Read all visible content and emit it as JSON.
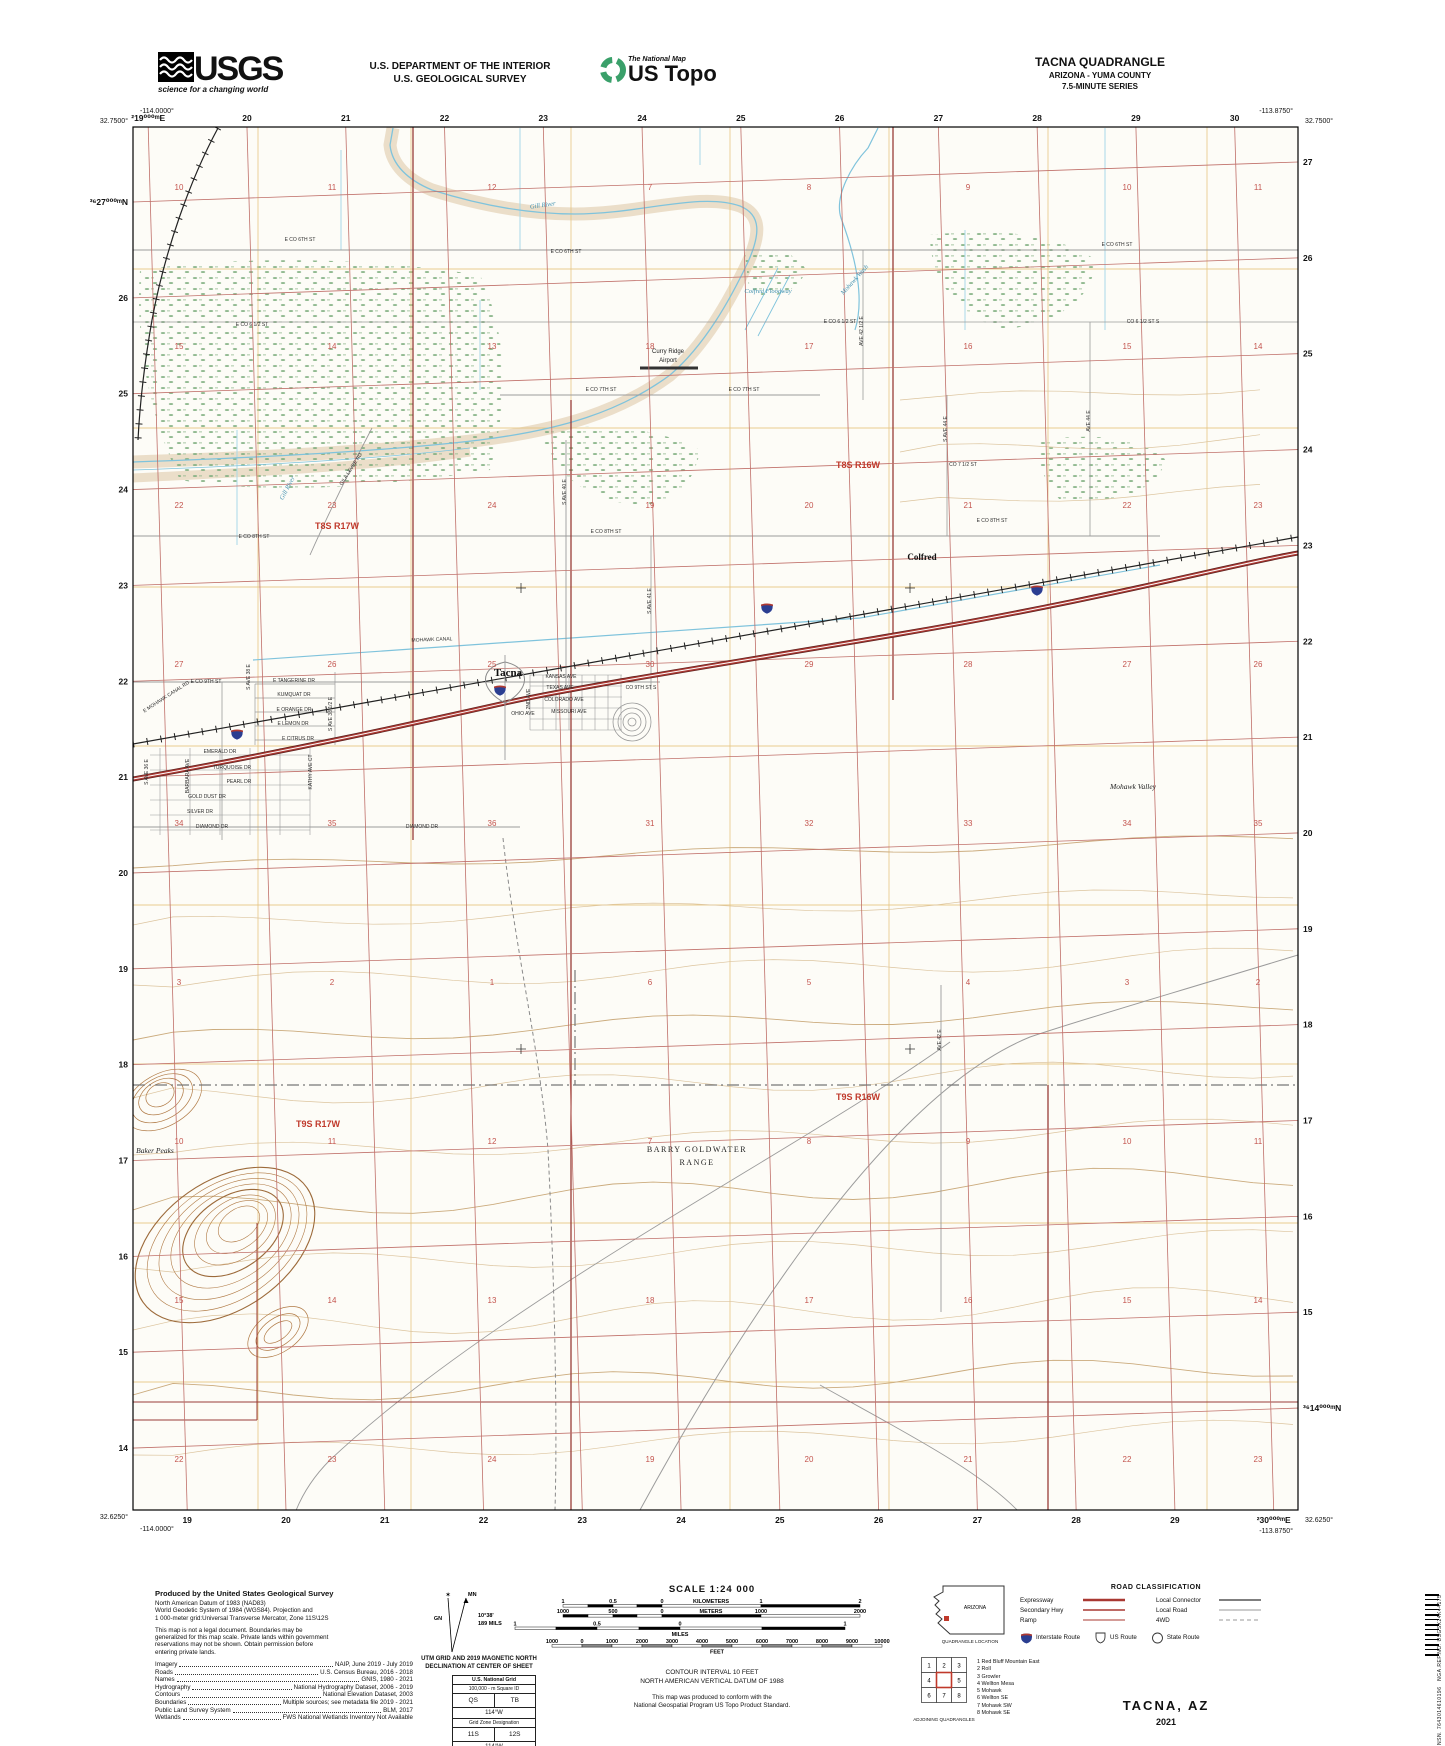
{
  "header": {
    "usgs_logo": {
      "wordmark": "USGS",
      "tagline": "science for a changing world"
    },
    "department_line1": "U.S. DEPARTMENT OF THE INTERIOR",
    "department_line2": "U.S. GEOLOGICAL SURVEY",
    "ustopo_logo": {
      "tagline": "The National Map",
      "title": "US Topo"
    },
    "quadrangle": {
      "title": "TACNA QUADRANGLE",
      "subtitle": "ARIZONA - YUMA COUNTY",
      "series": "7.5-MINUTE SERIES"
    }
  },
  "map": {
    "corner_coords": {
      "top_left_lon": "-114.0000°",
      "top_left_lat": "32.7500°",
      "top_right_lon": "-113.8750°",
      "top_right_lat": "32.7500°",
      "bottom_left_lat": "32.6250°",
      "bottom_left_lon": "-114.0000°",
      "bottom_right_lon": "-113.8750°",
      "bottom_right_lat": "32.6250°"
    },
    "utm_edge_labels": {
      "top": [
        "²19⁰⁰⁰ᵐE",
        "20",
        "21",
        "22",
        "23",
        "24",
        "25",
        "26",
        "27",
        "28",
        "29",
        "30"
      ],
      "bottom": [
        "19",
        "20",
        "21",
        "22",
        "23",
        "24",
        "25",
        "26",
        "27",
        "28",
        "29",
        "²30⁰⁰⁰ᵐE"
      ],
      "left": [
        "³⁶27⁰⁰⁰ᵐN",
        "26",
        "25",
        "24",
        "23",
        "22",
        "21",
        "20",
        "19",
        "18",
        "17",
        "16",
        "15",
        "14"
      ],
      "right": [
        "27",
        "26",
        "25",
        "24",
        "23",
        "22",
        "21",
        "20",
        "19",
        "18",
        "17",
        "16",
        "15",
        "³⁶14⁰⁰⁰ᵐN"
      ]
    },
    "section_numbers": {
      "cols": [
        179,
        332,
        492,
        650,
        809,
        968,
        1127,
        1258
      ],
      "rows": [
        190,
        349,
        508,
        667,
        826,
        985,
        1144,
        1303,
        1462
      ],
      "values": [
        [
          "10",
          "11",
          "12",
          "7",
          "8",
          "9",
          "10",
          "11"
        ],
        [
          "15",
          "14",
          "13",
          "18",
          "17",
          "16",
          "15",
          "14"
        ],
        [
          "22",
          "23",
          "24",
          "19",
          "20",
          "21",
          "22",
          "23"
        ],
        [
          "27",
          "26",
          "25",
          "30",
          "29",
          "28",
          "27",
          "26"
        ],
        [
          "34",
          "35",
          "36",
          "31",
          "32",
          "33",
          "34",
          "35"
        ],
        [
          "3",
          "2",
          "1",
          "6",
          "5",
          "4",
          "3",
          "2"
        ],
        [
          "10",
          "11",
          "12",
          "7",
          "8",
          "9",
          "10",
          "11"
        ],
        [
          "15",
          "14",
          "13",
          "18",
          "17",
          "16",
          "15",
          "14"
        ],
        [
          "22",
          "23",
          "24",
          "19",
          "20",
          "21",
          "22",
          "23"
        ]
      ]
    },
    "township_labels": [
      {
        "t": "T8S R17W",
        "x": 337,
        "y": 529
      },
      {
        "t": "T8S R16W",
        "x": 858,
        "y": 468
      },
      {
        "t": "T9S R17W",
        "x": 318,
        "y": 1127
      },
      {
        "t": "T9S R16W",
        "x": 858,
        "y": 1100
      }
    ],
    "place_labels": [
      {
        "t": "Tacna",
        "x": 508,
        "y": 676,
        "c": "t-place"
      },
      {
        "t": "Colfred",
        "x": 922,
        "y": 560,
        "c": "t-place2"
      },
      {
        "t": "Curry Ridge",
        "x": 668,
        "y": 353,
        "c": "t-place-sm"
      },
      {
        "t": "Airport",
        "x": 668,
        "y": 362,
        "c": "t-place-sm"
      },
      {
        "t": "Mohawk Valley",
        "x": 1133,
        "y": 789,
        "c": "t-valley"
      },
      {
        "t": "Baker Peaks",
        "x": 155,
        "y": 1153,
        "c": "t-valley"
      },
      {
        "t": "BARRY GOLDWATER",
        "x": 697,
        "y": 1152,
        "c": "t-range"
      },
      {
        "t": "RANGE",
        "x": 697,
        "y": 1165,
        "c": "t-range"
      }
    ],
    "water_labels": [
      {
        "t": "Gill River",
        "x": 543,
        "y": 207,
        "r": -8
      },
      {
        "t": "Gill River",
        "x": 289,
        "y": 489,
        "r": -62
      },
      {
        "t": "Mohawk Wash",
        "x": 856,
        "y": 281,
        "r": -48
      },
      {
        "t": "Colfred Floodway",
        "x": 768,
        "y": 293,
        "r": 0
      }
    ],
    "street_labels": [
      {
        "t": "E CO 6TH ST",
        "x": 300,
        "y": 241
      },
      {
        "t": "E CO 6TH ST",
        "x": 566,
        "y": 253
      },
      {
        "t": "E CO 6TH ST",
        "x": 1117,
        "y": 246
      },
      {
        "t": "E CO 6 1/2 ST",
        "x": 252,
        "y": 326
      },
      {
        "t": "E CO 6 1/2 ST",
        "x": 840,
        "y": 323
      },
      {
        "t": "CO 6 1/2 ST S",
        "x": 1143,
        "y": 323
      },
      {
        "t": "E CO 7TH ST",
        "x": 601,
        "y": 391
      },
      {
        "t": "E CO 7TH ST",
        "x": 744,
        "y": 391
      },
      {
        "t": "CO 7 1/2 ST",
        "x": 963,
        "y": 466
      },
      {
        "t": "E CO 8TH ST",
        "x": 254,
        "y": 538
      },
      {
        "t": "E CO 8TH ST",
        "x": 606,
        "y": 533
      },
      {
        "t": "E CO 8TH ST",
        "x": 992,
        "y": 522
      },
      {
        "t": "E CO 9TH ST",
        "x": 206,
        "y": 683
      },
      {
        "t": "CO 9TH ST S",
        "x": 641,
        "y": 689
      },
      {
        "t": "MOHAWK CANAL",
        "x": 432,
        "y": 641,
        "r": -2
      },
      {
        "t": "E MOHAWK CANAL RD",
        "x": 167,
        "y": 698,
        "r": -33
      },
      {
        "t": "GILA LEVEE RD",
        "x": 352,
        "y": 470,
        "r": -57
      },
      {
        "t": "E TANGERINE DR",
        "x": 294,
        "y": 682
      },
      {
        "t": "KUMQUAT DR",
        "x": 294,
        "y": 696
      },
      {
        "t": "E ORANGE DR",
        "x": 294,
        "y": 711
      },
      {
        "t": "E LEMON DR",
        "x": 293,
        "y": 725
      },
      {
        "t": "E CITRUS DR",
        "x": 298,
        "y": 740
      },
      {
        "t": "S AVE 38 E",
        "x": 250,
        "y": 677,
        "r": -90
      },
      {
        "t": "S AVE 38 1/2 E",
        "x": 332,
        "y": 714,
        "r": -90
      },
      {
        "t": "KANSAS AVE",
        "x": 561,
        "y": 678
      },
      {
        "t": "TEXAS AVE",
        "x": 560,
        "y": 689
      },
      {
        "t": "COLORADO AVE",
        "x": 564,
        "y": 701
      },
      {
        "t": "MISSOURI AVE",
        "x": 569,
        "y": 713
      },
      {
        "t": "OHIO AVE",
        "x": 523,
        "y": 715
      },
      {
        "t": "2ND AVE",
        "x": 530,
        "y": 699,
        "r": -90
      },
      {
        "t": "EMERALD DR",
        "x": 220,
        "y": 753
      },
      {
        "t": "TURQUOISE DR",
        "x": 232,
        "y": 769
      },
      {
        "t": "PEARL DR",
        "x": 239,
        "y": 783
      },
      {
        "t": "GOLD DUST DR",
        "x": 207,
        "y": 798
      },
      {
        "t": "SILVER DR",
        "x": 200,
        "y": 813
      },
      {
        "t": "DIAMOND DR",
        "x": 212,
        "y": 828
      },
      {
        "t": "DIAMOND DR",
        "x": 422,
        "y": 828
      },
      {
        "t": "BARBARA AVE",
        "x": 189,
        "y": 776,
        "r": -90
      },
      {
        "t": "KATHY AVE CT",
        "x": 312,
        "y": 772,
        "r": -90
      },
      {
        "t": "S AVE 36 E",
        "x": 148,
        "y": 772,
        "r": -90
      },
      {
        "t": "S AVE 40 E",
        "x": 566,
        "y": 492,
        "r": -90
      },
      {
        "t": "S AVE 41 E",
        "x": 651,
        "y": 601,
        "r": -90
      },
      {
        "t": "AVE 42 1/2 E",
        "x": 863,
        "y": 331,
        "r": -90
      },
      {
        "t": "S AVE 44 E",
        "x": 947,
        "y": 429,
        "r": -90
      },
      {
        "t": "AVE 44 E",
        "x": 1090,
        "y": 421,
        "r": -90
      },
      {
        "t": "AVE 42 E",
        "x": 941,
        "y": 1040,
        "r": -90
      }
    ],
    "colors": {
      "utm_grid": "#c0706a",
      "section_line": "#e6c47e",
      "water": "#7fc3dc",
      "contour": "#c8a473",
      "section_number": "#c4554f",
      "township": "#c0392b",
      "interstate": "#a93832",
      "interstate_shield": "#2b3e91",
      "vegetation": "#7fae7f"
    }
  },
  "footer": {
    "produced_by": {
      "title": "Produced by the United States Geological Survey",
      "intro_lines": [
        "North American Datum of 1983 (NAD83)",
        "World Geodetic System of 1984 (WGS84).  Projection and",
        "1 000-meter grid:Universal Transverse Mercator, Zone 11S\\12S"
      ],
      "note_lines": [
        "This map is not a legal document. Boundaries may be",
        "generalized for this map scale. Private lands within government",
        "reservations may not be shown. Obtain permission before",
        "entering private lands."
      ],
      "credits": [
        {
          "label": "Imagery",
          "value": "NAIP, June 2019 - July 2019"
        },
        {
          "label": "Roads",
          "value": "U.S. Census Bureau, 2016 - 2018"
        },
        {
          "label": "Names",
          "value": "GNIS, 1980 - 2021"
        },
        {
          "label": "Hydrography",
          "value": "National Hydrography Dataset, 2006 - 2019"
        },
        {
          "label": "Contours",
          "value": "National Elevation Dataset, 2003"
        },
        {
          "label": "Boundaries",
          "value": "Multiple sources; see metadata file 2019 - 2021"
        },
        {
          "label": "Public Land Survey System",
          "value": "BLM, 2017"
        },
        {
          "label": "Wetlands",
          "value": "FWS National Wetlands Inventory Not Available"
        }
      ]
    },
    "declination": {
      "gn": "GN",
      "mn": "MN",
      "angle": "10°38'",
      "mils": "189 MILS",
      "caption1": "UTM GRID AND 2019 MAGNETIC NORTH",
      "caption2": "DECLINATION AT CENTER OF SHEET"
    },
    "usng": {
      "title": "U.S. National Grid",
      "square_label": "100,000 - m Square ID",
      "square_a": "QS",
      "square_b": "TB",
      "meridian_a": "114°W",
      "zone_label": "Grid Zone Designation",
      "zone_a": "11S",
      "zone_b": "12S",
      "meridian_b": "114°W"
    },
    "scale": {
      "title": "SCALE 1:24 000",
      "bars": [
        {
          "unit": "KILOMETERS",
          "labels": [
            "1",
            "0.5",
            "0",
            "KILOMETERS",
            "1",
            "2"
          ],
          "unit_inline": true
        },
        {
          "unit": "METERS",
          "labels": [
            "1000",
            "500",
            "0",
            "METERS",
            "1000",
            "2000"
          ],
          "unit_inline": true
        },
        {
          "unit": "MILES",
          "labels": [
            "1",
            "0.5",
            "0",
            "1"
          ],
          "unit_inline": false
        },
        {
          "unit": "FEET",
          "labels": [
            "1000",
            "0",
            "1000",
            "2000",
            "3000",
            "4000",
            "5000",
            "6000",
            "7000",
            "8000",
            "9000",
            "10000"
          ],
          "unit_inline": false
        }
      ],
      "contour_line": "CONTOUR INTERVAL 10 FEET",
      "datum_line": "NORTH AMERICAN VERTICAL DATUM OF 1988",
      "conform_line1": "This map was produced to conform with the",
      "conform_line2": "National Geospatial Program US Topo Product Standard."
    },
    "location": {
      "state": "ARIZONA",
      "caption": "QUADRANGLE LOCATION"
    },
    "adjoining": {
      "caption": "ADJOINING QUADRANGLES",
      "cells": [
        "1",
        "2",
        "3",
        "4",
        "",
        "5",
        "6",
        "7",
        "8"
      ],
      "list": [
        "1 Red Bluff Mountain East",
        "2 Roll",
        "3 Growler",
        "4 Wellton Mesa",
        "5 Mohawk",
        "6 Wellton SE",
        "7 Mohawk SW",
        "8 Mohawk SE"
      ]
    },
    "road_class": {
      "title": "ROAD CLASSIFICATION",
      "left": [
        "Expressway",
        "Secondary Hwy",
        "Ramp"
      ],
      "right": [
        "Local Connector",
        "Local Road",
        "4WD"
      ],
      "routes": [
        "Interstate Route",
        "US Route",
        "State Route"
      ]
    },
    "sheet": {
      "name": "TACNA,  AZ",
      "year": "2021"
    },
    "sidecode_line1": "NSN. 7643014610196",
    "sidecode_line2": "NGA.REF.NO. USGSX24K44175"
  }
}
